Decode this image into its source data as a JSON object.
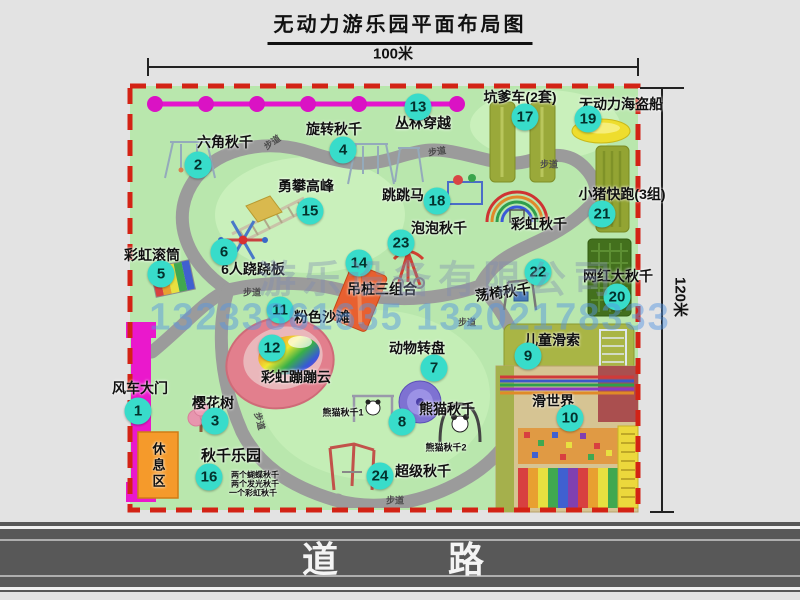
{
  "title": "无动力游乐园平面布局图",
  "dimensions": {
    "width": "100米",
    "height": "120米"
  },
  "road": {
    "label": "道    路"
  },
  "watermark": {
    "company": "游乐设备有限公司",
    "phone": "13233861635 13202178333"
  },
  "path_label_text": "步道",
  "path_labels": [
    {
      "x": 272,
      "y": 142,
      "r": -35
    },
    {
      "x": 437,
      "y": 151,
      "r": -8
    },
    {
      "x": 549,
      "y": 164,
      "r": 0
    },
    {
      "x": 252,
      "y": 292,
      "r": 0
    },
    {
      "x": 260,
      "y": 421,
      "r": 75
    },
    {
      "x": 395,
      "y": 500,
      "r": 0
    },
    {
      "x": 467,
      "y": 322,
      "r": 0
    }
  ],
  "items": [
    {
      "id": "windmill-gate",
      "num": "1",
      "name": "风车大门",
      "badge": [
        138,
        411
      ],
      "label": [
        140,
        388
      ]
    },
    {
      "id": "hexagon-swing",
      "num": "2",
      "name": "六角秋千",
      "badge": [
        198,
        165
      ],
      "label": [
        225,
        142
      ]
    },
    {
      "id": "cherry-tree",
      "num": "3",
      "name": "樱花树",
      "badge": [
        215,
        421
      ],
      "label": [
        213,
        403
      ]
    },
    {
      "id": "rotating-swing",
      "num": "4",
      "name": "旋转秋千",
      "badge": [
        343,
        150
      ],
      "label": [
        334,
        129
      ]
    },
    {
      "id": "rainbow-roller",
      "num": "5",
      "name": "彩虹滚筒",
      "badge": [
        161,
        274
      ],
      "label": [
        152,
        255
      ]
    },
    {
      "id": "six-person-seesaw",
      "num": "6",
      "name": "6人跷跷板",
      "badge": [
        224,
        252
      ],
      "label": [
        253,
        269
      ]
    },
    {
      "id": "animal-turntable",
      "num": "7",
      "name": "动物转盘",
      "badge": [
        434,
        368
      ],
      "label": [
        417,
        348
      ]
    },
    {
      "id": "panda-swing",
      "num": "8",
      "name": "熊猫秋千",
      "badge": [
        402,
        422
      ],
      "label": [
        447,
        409
      ]
    },
    {
      "id": "kids-zipline",
      "num": "9",
      "name": "儿童滑索",
      "badge": [
        528,
        356
      ],
      "label": [
        552,
        340
      ]
    },
    {
      "id": "slide-world",
      "num": "10",
      "name": "滑世界",
      "badge": [
        570,
        418
      ],
      "label": [
        553,
        401
      ]
    },
    {
      "id": "pink-beach",
      "num": "11",
      "name": "粉色沙滩",
      "badge": [
        280,
        310
      ],
      "label": [
        322,
        317
      ]
    },
    {
      "id": "rainbow-bounce-cloud",
      "num": "12",
      "name": "彩虹蹦蹦云",
      "badge": [
        272,
        348
      ],
      "label": [
        296,
        377
      ]
    },
    {
      "id": "jungle-crossing",
      "num": "13",
      "name": "丛林穿越",
      "badge": [
        418,
        107
      ],
      "label": [
        423,
        123
      ]
    },
    {
      "id": "hanging-pile-combo",
      "num": "14",
      "name": "吊桩三组合",
      "badge": [
        359,
        263
      ],
      "label": [
        382,
        289
      ]
    },
    {
      "id": "brave-climb",
      "num": "15",
      "name": "勇攀高峰",
      "badge": [
        310,
        211
      ],
      "label": [
        306,
        186
      ]
    },
    {
      "id": "swing-park",
      "num": "16",
      "name": "秋千乐园",
      "badge": [
        209,
        477
      ],
      "label": [
        231,
        455
      ],
      "ls": 15
    },
    {
      "id": "pit-cart",
      "num": "17",
      "name": "坑爹车(2套)",
      "badge": [
        525,
        117
      ],
      "label": [
        520,
        97
      ]
    },
    {
      "id": "jumping-horse",
      "num": "18",
      "name": "跳跳马",
      "badge": [
        437,
        201
      ],
      "label": [
        403,
        195
      ]
    },
    {
      "id": "pirate-ship",
      "num": "19",
      "name": "无动力海盗船",
      "badge": [
        588,
        119
      ],
      "label": [
        621,
        104
      ]
    },
    {
      "id": "big-swing",
      "num": "20",
      "name": "网红大秋千",
      "badge": [
        617,
        297
      ],
      "label": [
        618,
        276
      ]
    },
    {
      "id": "piggy-run",
      "num": "21",
      "name": "小猪快跑(3组)",
      "badge": [
        602,
        214
      ],
      "label": [
        622,
        194
      ]
    },
    {
      "id": "swing-chair",
      "num": "22",
      "name": "荡椅秋千",
      "badge": [
        538,
        272
      ],
      "label": [
        503,
        292
      ],
      "rot": -8
    },
    {
      "id": "bubble-swing",
      "num": "23",
      "name": "泡泡秋千",
      "badge": [
        401,
        243
      ],
      "label": [
        439,
        228
      ]
    },
    {
      "id": "super-swing",
      "num": "24",
      "name": "超级秋千",
      "badge": [
        380,
        476
      ],
      "label": [
        423,
        471
      ]
    },
    {
      "id": "rainbow-swing",
      "name": "彩虹秋千",
      "label": [
        539,
        224
      ]
    },
    {
      "id": "rest-area",
      "name": "休息区",
      "label": [
        158,
        466
      ],
      "ls": 13,
      "vertical": true
    },
    {
      "id": "panda-swing-1",
      "name": "熊猫秋千1",
      "label": [
        343,
        412
      ],
      "ls": 9
    },
    {
      "id": "panda-swing-2",
      "name": "熊猫秋千2",
      "label": [
        446,
        447
      ],
      "ls": 9
    },
    {
      "id": "swing-park-note-1",
      "name": "两个蝴蝶秋千",
      "label": [
        255,
        475
      ],
      "ls": 8
    },
    {
      "id": "swing-park-note-2",
      "name": "两个发光秋千",
      "label": [
        255,
        484
      ],
      "ls": 8
    },
    {
      "id": "swing-park-note-3",
      "name": "一个彩虹秋千",
      "label": [
        253,
        493
      ],
      "ls": 8
    }
  ]
}
